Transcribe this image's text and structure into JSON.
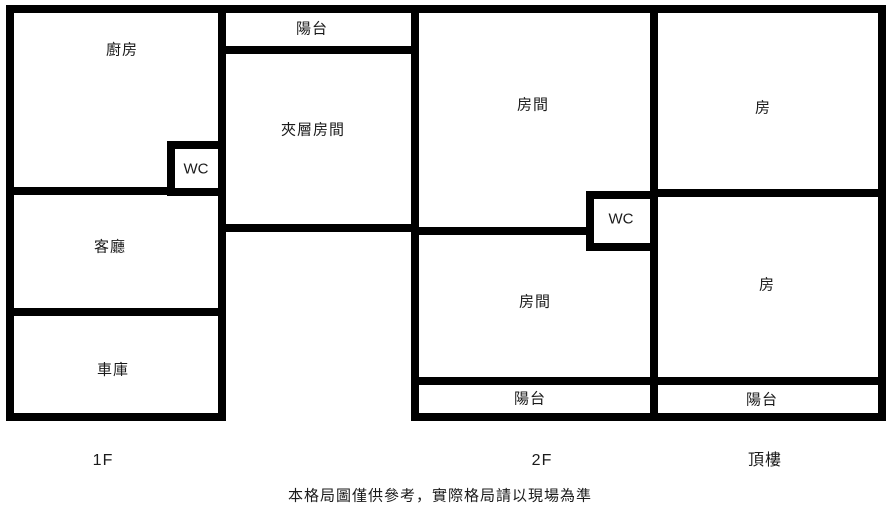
{
  "colors": {
    "wall": "#000000",
    "background": "#ffffff",
    "text": "#1a1a1a"
  },
  "rooms": {
    "kitchen": {
      "label": "廚房"
    },
    "balcony_1f": {
      "label": "陽台"
    },
    "mezzanine": {
      "label": "夾層房間"
    },
    "wc_1f": {
      "label": "WC"
    },
    "living_room": {
      "label": "客廳"
    },
    "garage": {
      "label": "車庫"
    },
    "bedroom_2f_top": {
      "label": "房間"
    },
    "wc_2f": {
      "label": "WC"
    },
    "bedroom_2f_bottom": {
      "label": "房間"
    },
    "balcony_2f": {
      "label": "陽台"
    },
    "room_roof_top": {
      "label": "房"
    },
    "room_roof_bottom": {
      "label": "房"
    },
    "balcony_roof": {
      "label": "陽台"
    }
  },
  "floor_labels": {
    "f1": "1F",
    "f2": "2F",
    "roof": "頂樓"
  },
  "footer": {
    "disclaimer": "本格局圖僅供參考，實際格局請以現場為準"
  }
}
